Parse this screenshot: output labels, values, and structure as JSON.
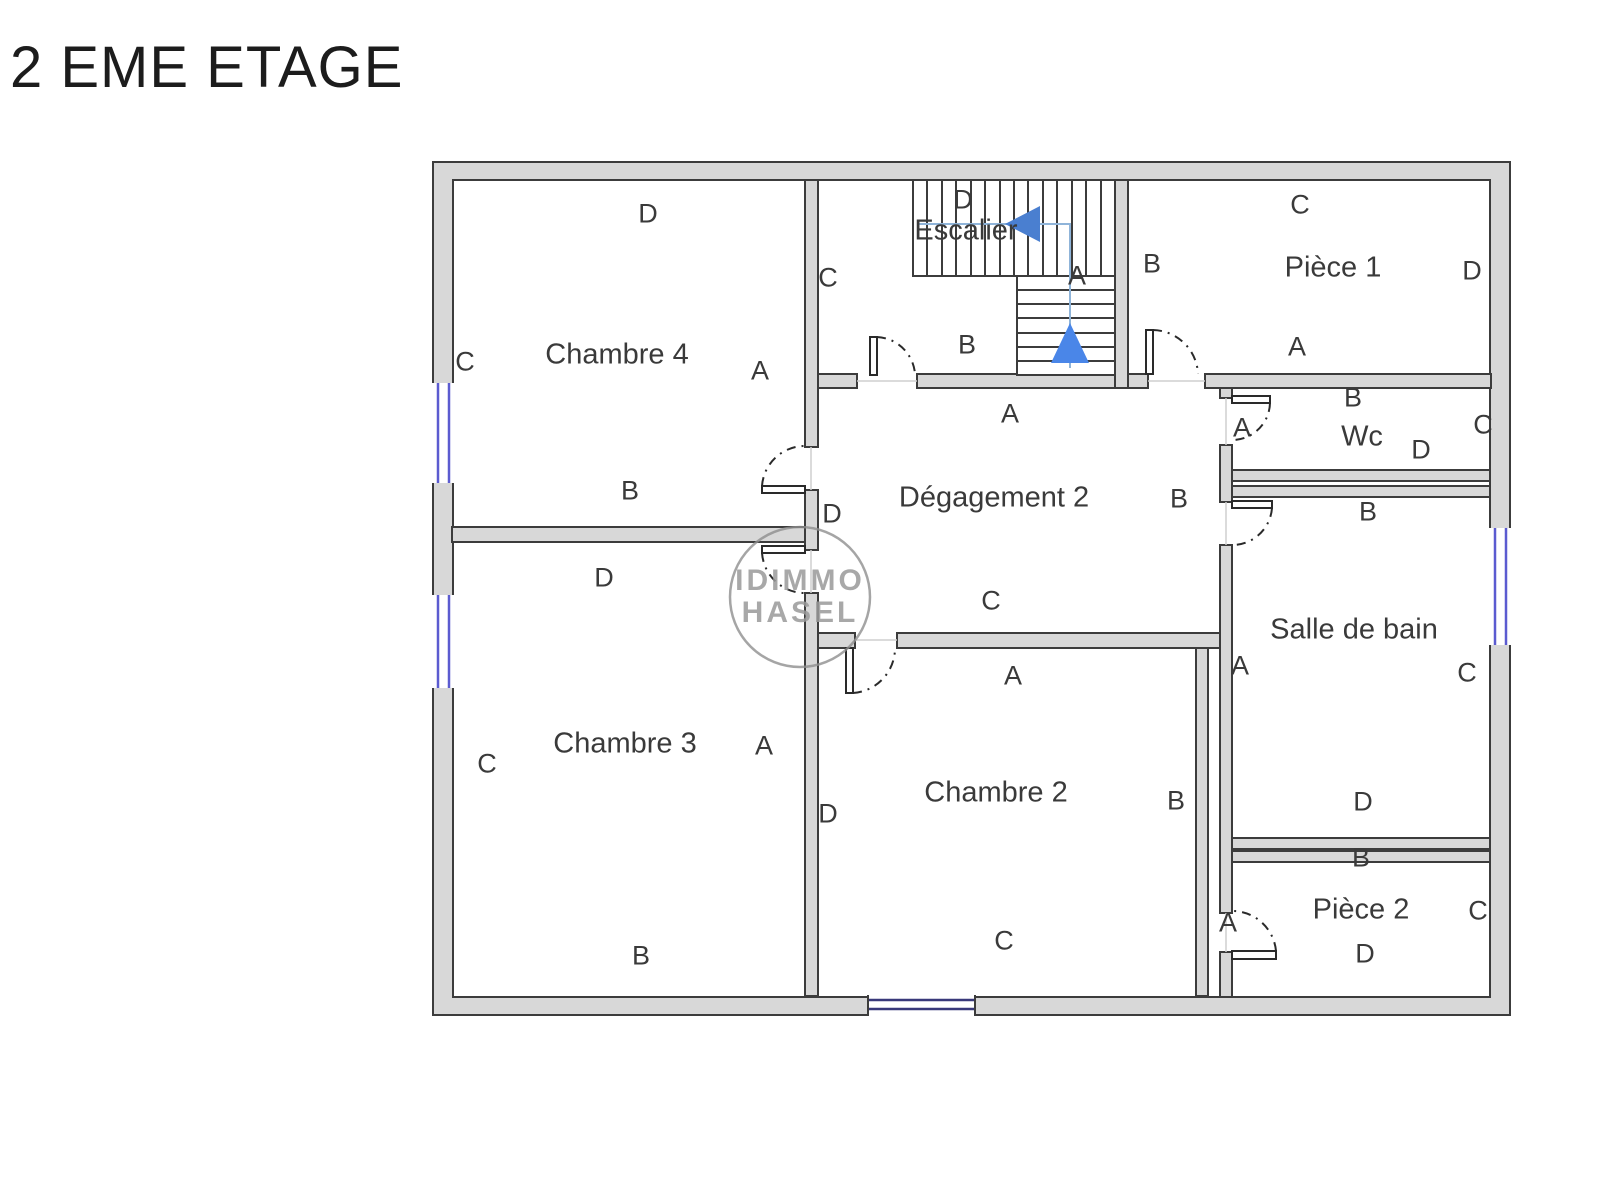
{
  "title": "2 EME ETAGE",
  "watermark": {
    "line1": "IDIMMO",
    "line2": "HASEL"
  },
  "colors": {
    "wall_fill": "#d8d8d8",
    "wall_stroke": "#3c3c3c",
    "window_blue": "#5b5bd0",
    "stair_line_blue": "#8fb4d9",
    "stair_arrow_blue": "#4a86e8",
    "watermark_gray": "#9a9a9a",
    "label_text": "#3a3a3a"
  },
  "rooms": {
    "chambre4": {
      "name": "Chambre 4",
      "top": "D",
      "left": "C",
      "right": "A",
      "bottom": "B"
    },
    "chambre3": {
      "name": "Chambre 3",
      "top": "D",
      "left": "C",
      "right": "A",
      "bottom": "B"
    },
    "escalier": {
      "name": "Escalier",
      "top": "D",
      "left": "C",
      "right": "A",
      "bottom": "B"
    },
    "piece1": {
      "name": "Pièce 1",
      "top": "C",
      "left": "B",
      "right": "D",
      "bottom": "A"
    },
    "degagement2": {
      "name": "Dégagement 2",
      "top": "A",
      "left": "D",
      "right": "B",
      "bottom": "C"
    },
    "wc": {
      "name": "Wc",
      "top": "B",
      "left": "A",
      "right": "C",
      "bottom": "D"
    },
    "salledebain": {
      "name": "Salle de bain",
      "top": "B",
      "left": "A",
      "right": "C",
      "bottom": "D"
    },
    "chambre2": {
      "name": "Chambre 2",
      "top": "A",
      "left": "D",
      "right": "B",
      "bottom": "C"
    },
    "piece2": {
      "name": "Pièce 2",
      "top": "B",
      "left": "A",
      "right": "C",
      "bottom": "D"
    }
  }
}
